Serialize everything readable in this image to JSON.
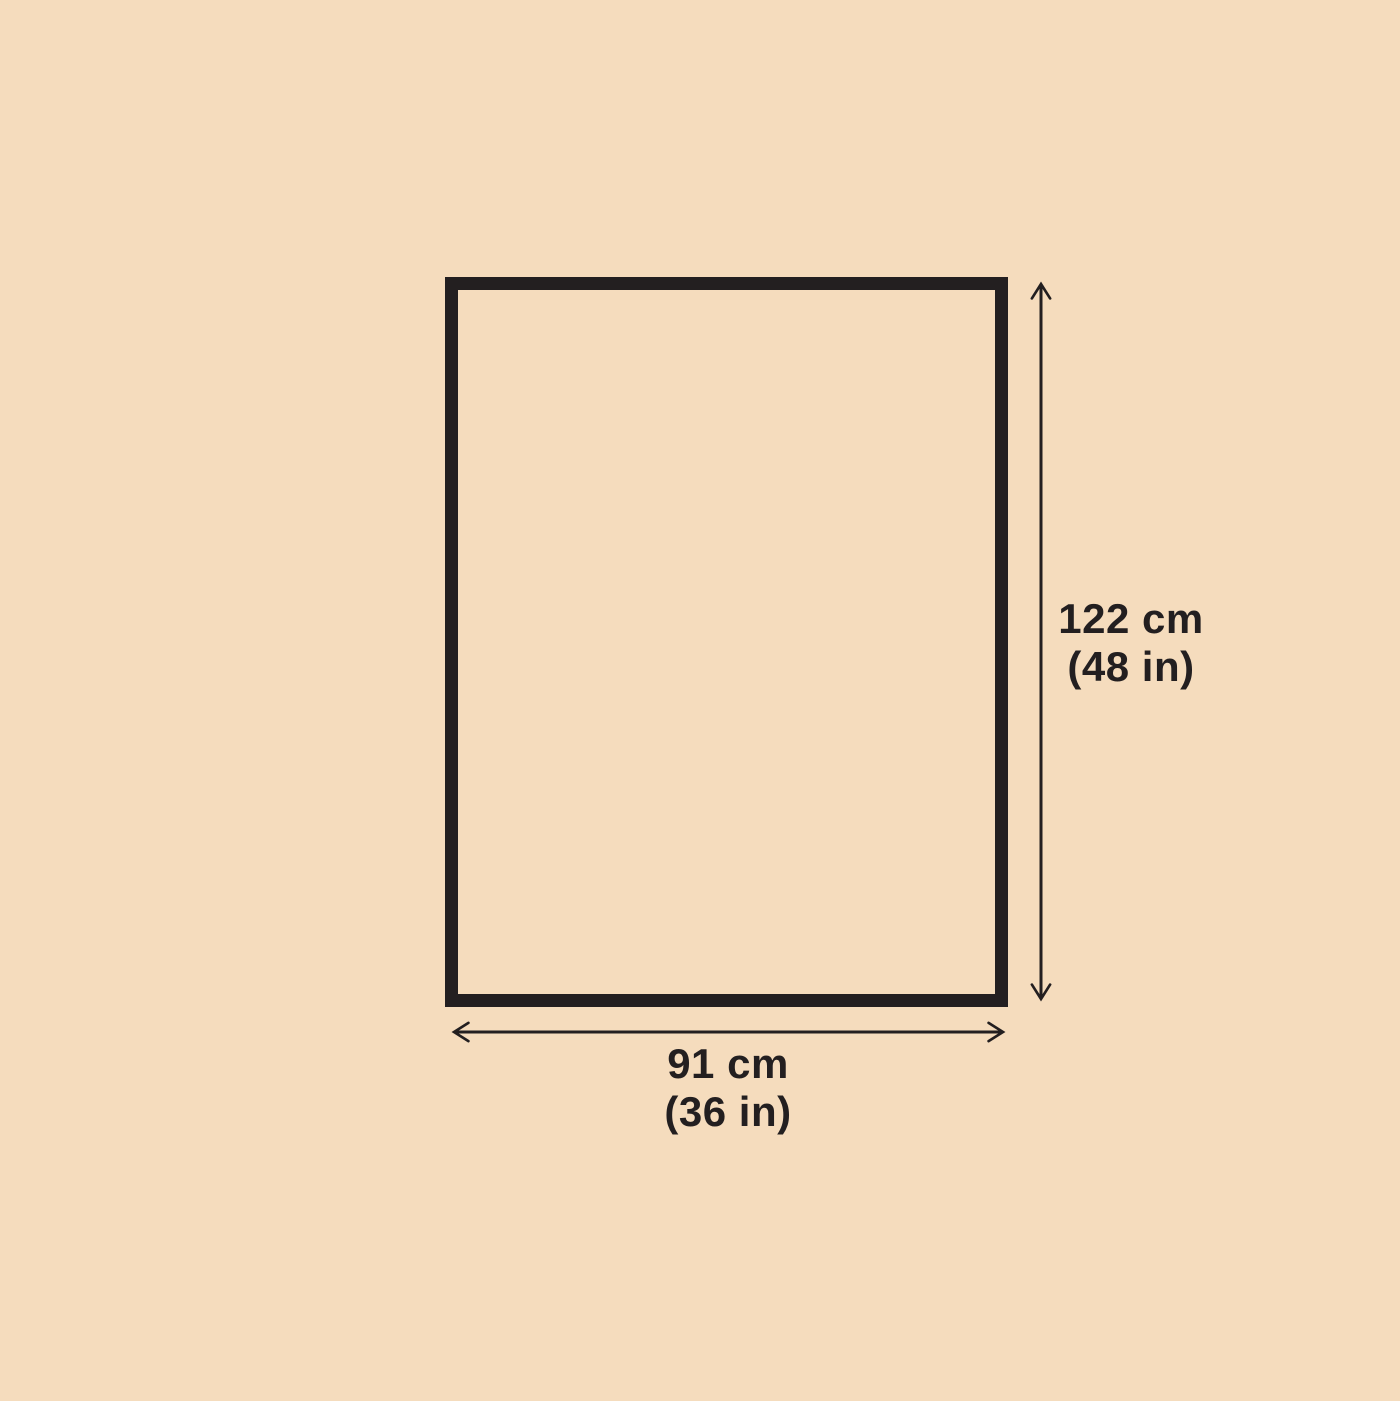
{
  "diagram": {
    "type": "dimension-diagram",
    "shape": "rectangle"
  },
  "colors": {
    "background": "#F5DCBD",
    "outline": "#231F20",
    "arrow": "#231F20",
    "text": "#231F20"
  },
  "dimensions": {
    "height": {
      "metric": "122 cm",
      "imperial": "(48 in)"
    },
    "width": {
      "metric": "91 cm",
      "imperial": "(36 in)"
    }
  }
}
